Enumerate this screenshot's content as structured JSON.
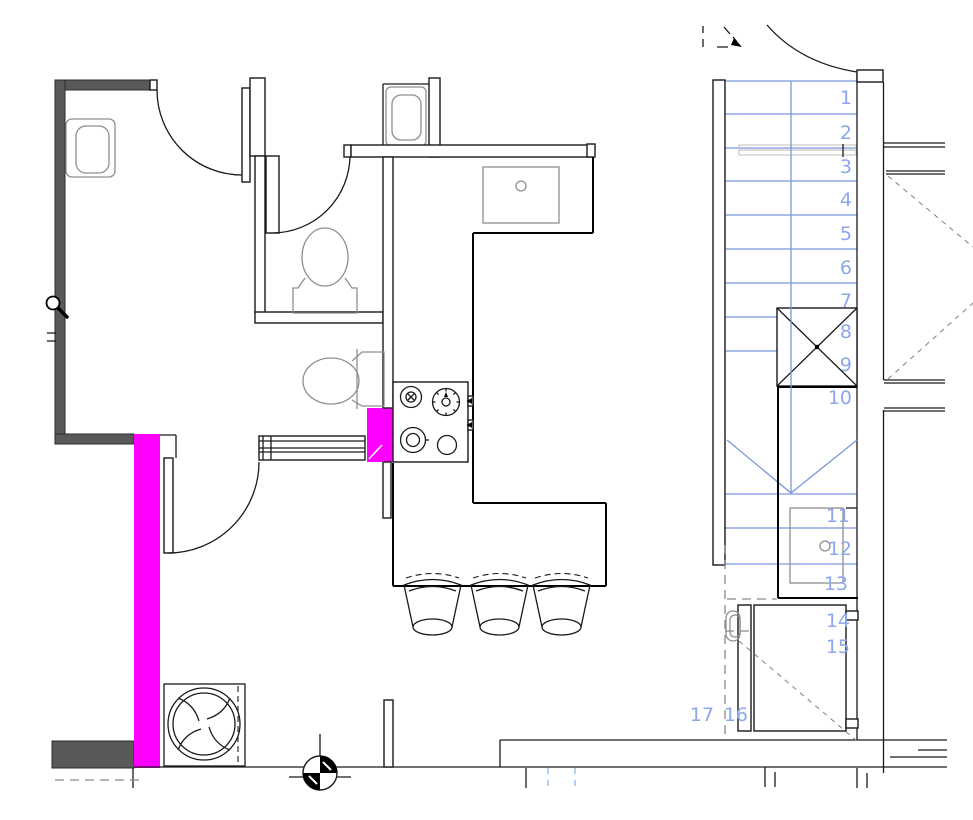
{
  "plan": {
    "title": "apartment-floor-plan",
    "stairs": {
      "numbers": [
        "1",
        "2",
        "3",
        "4",
        "5",
        "6",
        "7",
        "8",
        "9",
        "10",
        "11",
        "12",
        "13",
        "14",
        "15",
        "16",
        "17"
      ]
    },
    "colors": {
      "highlight": "#ff00ff",
      "wall_dark": "#595959",
      "stair_line": "#7b96dc",
      "stair_text": "#8ca7ea",
      "fixture_gray": "#8f8f8f",
      "dash_gray": "#8a8a8a",
      "tick_blue": "#9cc3f0",
      "handrail_gray": "#c9c9c9"
    },
    "cursor": {
      "name": "magnifier-cursor"
    }
  }
}
